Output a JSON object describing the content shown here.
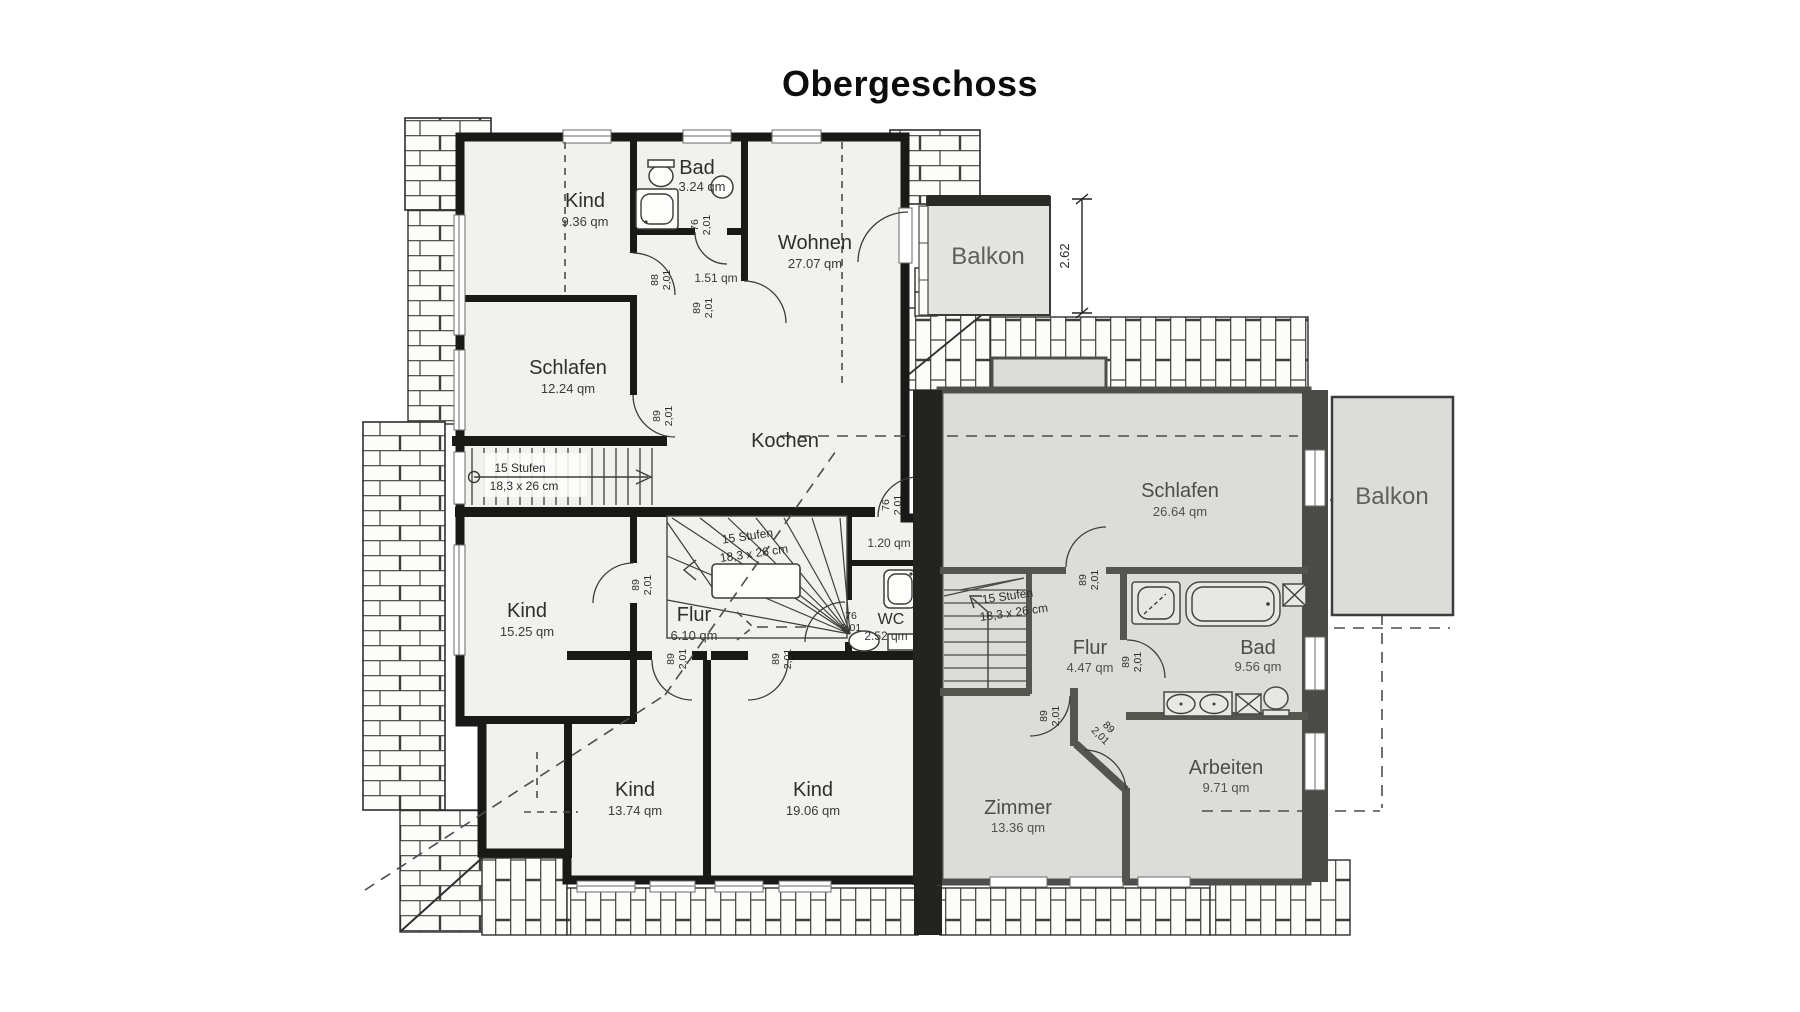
{
  "title": "Obergeschoss",
  "rooms": {
    "kind1": {
      "name": "Kind",
      "area": "9.36 qm"
    },
    "bad1": {
      "name": "Bad",
      "area": "3.24 qm"
    },
    "wohnen": {
      "name": "Wohnen",
      "area": "27.07 qm"
    },
    "schlafen1": {
      "name": "Schlafen",
      "area": "12.24 qm"
    },
    "kochen": {
      "name": "Kochen"
    },
    "vestibule": {
      "area": "1.51 qm"
    },
    "niche": {
      "area": "1.20 qm"
    },
    "kind2": {
      "name": "Kind",
      "area": "15.25 qm"
    },
    "flur1": {
      "name": "Flur",
      "area": "6.10 qm"
    },
    "wc": {
      "name": "WC",
      "area": "2.52 qm"
    },
    "kind3": {
      "name": "Kind",
      "area": "13.74 qm"
    },
    "kind4": {
      "name": "Kind",
      "area": "19.06 qm"
    },
    "balkon1": {
      "name": "Balkon"
    },
    "schlafen2": {
      "name": "Schlafen",
      "area": "26.64 qm"
    },
    "flur2": {
      "name": "Flur",
      "area": "4.47 qm"
    },
    "bad2": {
      "name": "Bad",
      "area": "9.56 qm"
    },
    "arbeiten": {
      "name": "Arbeiten",
      "area": "9.71 qm"
    },
    "zimmer": {
      "name": "Zimmer",
      "area": "13.36 qm"
    },
    "balkon2": {
      "name": "Balkon"
    }
  },
  "stairs": {
    "steps": "15 Stufen",
    "size": "18,3 x 26 cm"
  },
  "dimensions": {
    "balcony_depth": "2.62"
  },
  "doors": {
    "w76": "76",
    "w88": "88",
    "w89": "89",
    "h": "2,01"
  },
  "colors": {
    "left_unit_fill": "#f1f1ee",
    "right_unit_fill": "#dcddda",
    "wall": "#191917",
    "right_unit_wall": "#4e4e4c",
    "balcony_fill": "#e4e5e2"
  }
}
